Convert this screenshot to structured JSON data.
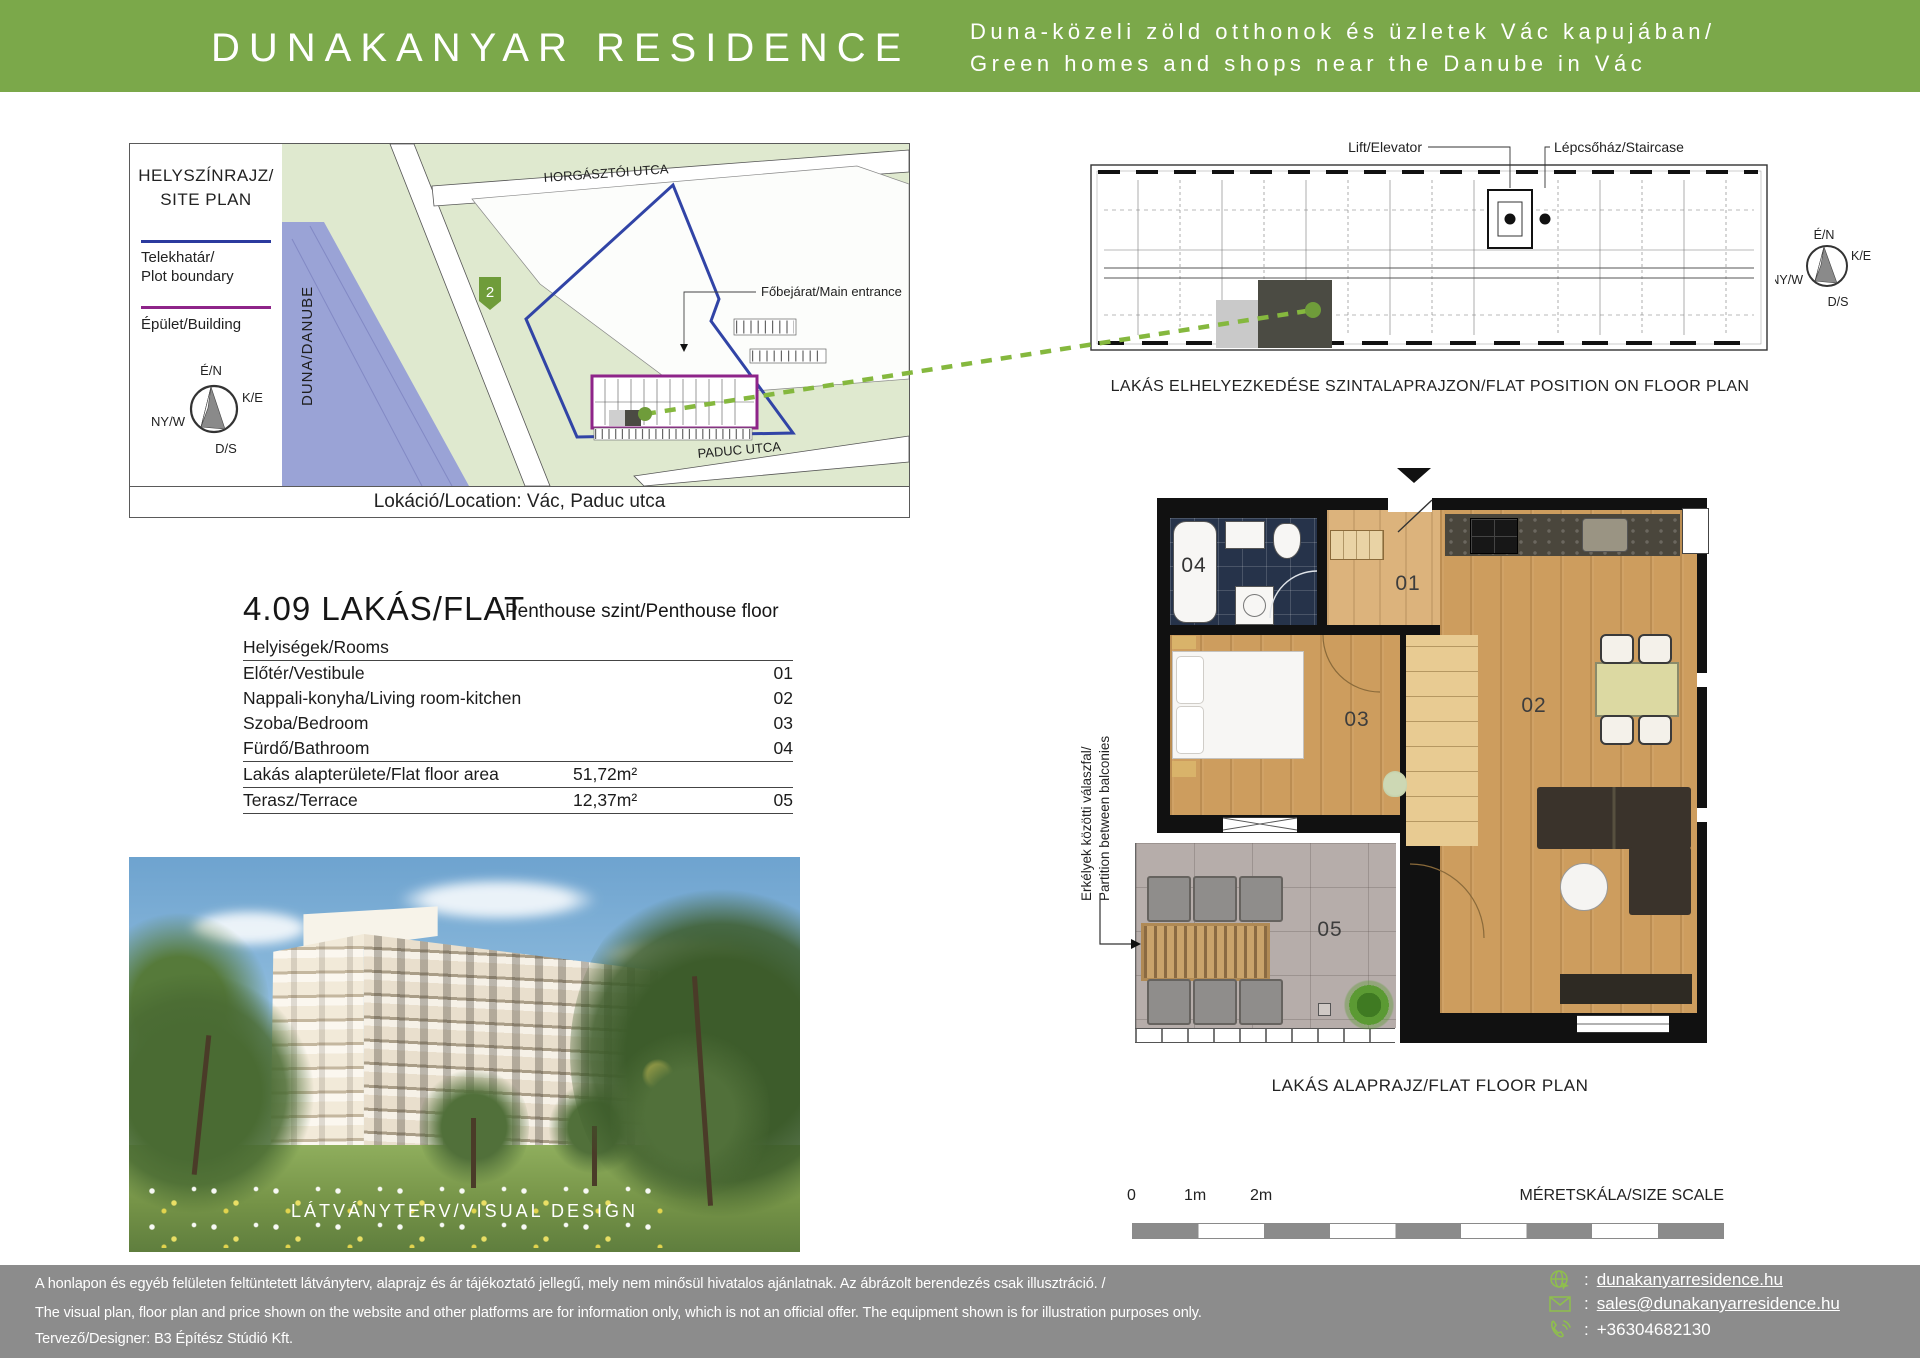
{
  "header": {
    "title": "DUNAKANYAR RESIDENCE",
    "tagline_hu": "Duna-közeli zöld otthonok és üzletek Vác kapujában/",
    "tagline_en": "Green homes and shops near the Danube in Vác",
    "accent_color": "#7ba84a"
  },
  "site_plan": {
    "title_hu": "HELYSZÍNRAJZ/",
    "title_en": "SITE PLAN",
    "legend_plot_hu": "Telekhatár/",
    "legend_plot_en": "Plot boundary",
    "legend_plot_color": "#2b3a9e",
    "legend_building": "Épület/Building",
    "legend_building_color": "#8e2489",
    "compass": {
      "n": "É/N",
      "e": "K/E",
      "w": "NY/W",
      "s": "D/S"
    },
    "street_top": "HORGÁSZTÓI UTCA",
    "street_bottom": "PADUC UTCA",
    "river": "DUNA/DANUBE",
    "marker": "2",
    "entrance": "Főbejárat/Main entrance",
    "caption": "Lokáció/Location: Vác, Paduc utca"
  },
  "floor_position": {
    "lift": "Lift/Elevator",
    "staircase": "Lépcsőház/Staircase",
    "caption": "LAKÁS ELHELYEZKEDÉSE SZINTALAPRAJZON/FLAT POSITION ON FLOOR PLAN",
    "compass": {
      "n": "É/N",
      "e": "K/E",
      "w": "NY/W",
      "s": "D/S"
    }
  },
  "flat": {
    "title": "4.09 LAKÁS/FLAT",
    "subtitle": "Penthouse szint/Penthouse floor",
    "rooms_header": "Helyiségek/Rooms",
    "rows": [
      {
        "name": "Előtér/Vestibule",
        "area": "",
        "num": "01"
      },
      {
        "name": "Nappali-konyha/Living room-kitchen",
        "area": "",
        "num": "02"
      },
      {
        "name": "Szoba/Bedroom",
        "area": "",
        "num": "03"
      },
      {
        "name": "Fürdő/Bathroom",
        "area": "",
        "num": "04"
      },
      {
        "name": "Lakás alapterülete/Flat floor area",
        "area": "51,72m²",
        "num": ""
      },
      {
        "name": "Terasz/Terrace",
        "area": "12,37m²",
        "num": "05"
      }
    ]
  },
  "visual": {
    "caption": "LÁTVÁNYTERV/VISUAL DESIGN"
  },
  "flat_plan": {
    "caption": "LAKÁS ALAPRAJZ/FLAT FLOOR PLAN",
    "partition_hu": "Erkélyek közötti válaszfal/",
    "partition_en": "Partition between balconies",
    "labels": {
      "r01": "01",
      "r02": "02",
      "r03": "03",
      "r04": "04",
      "r05": "05"
    }
  },
  "scale_bar": {
    "t0": "0",
    "t1": "1m",
    "t2": "2m",
    "label": "MÉRETSKÁLA/SIZE SCALE"
  },
  "footer": {
    "disclaimer_hu": "A honlapon és egyéb felületen feltüntetett látványterv, alaprajz és ár tájékoztató jellegű, mely nem minősül hivatalos ajánlatnak. Az ábrázolt berendezés csak illusztráció. /",
    "disclaimer_en": "The visual plan, floor plan and price shown on the website and other platforms are for information only, which is not an official offer. The equipment shown is for illustration purposes only.",
    "designer": "Tervező/Designer:  B3 Építész Stúdió Kft.",
    "sep": ":",
    "web": "dunakanyarresidence.hu",
    "email": "sales@dunakanyarresidence.hu",
    "phone": "+36304682130",
    "icon_color": "#8fbf4d"
  }
}
